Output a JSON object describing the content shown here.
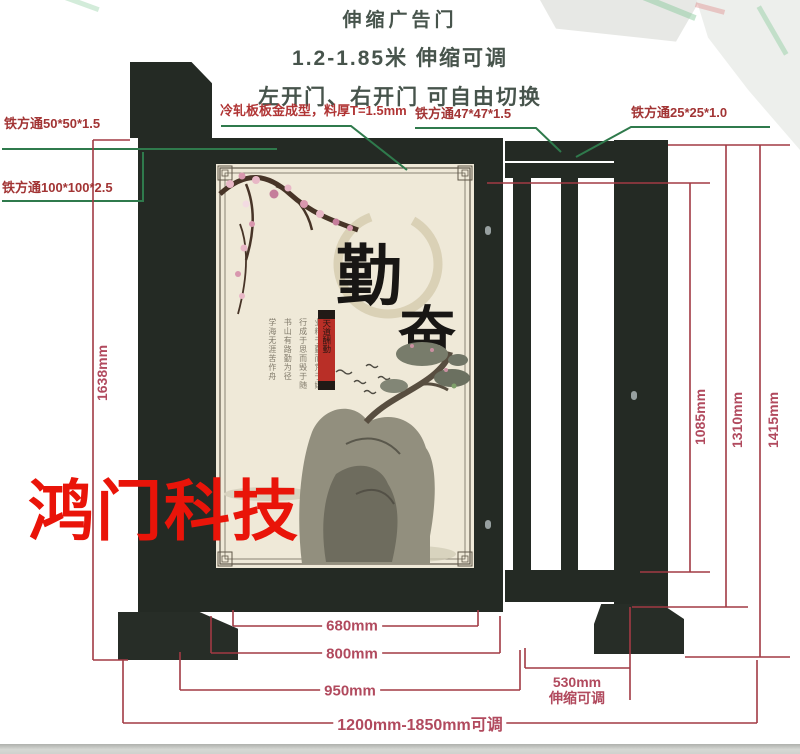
{
  "header": {
    "title": "伸缩广告门",
    "subtitle": "1.2-1.85米 伸缩可调",
    "note": "左开门、右开门 可自由切换"
  },
  "callouts": {
    "tube50": "铁方通50*50*1.5",
    "tube100": "铁方通100*100*2.5",
    "cold_plate": "冷轧板板金成型，料厚T=1.5mm",
    "tube47": "铁方通47*47*1.5",
    "tube25": "铁方通25*25*1.0"
  },
  "dimensions": {
    "height_left": "1638mm",
    "height_inner": "1085mm",
    "height_frame": "1310mm",
    "height_total": "1415mm",
    "width_panel": "680mm",
    "width_door": "800mm",
    "width_door_post": "950mm",
    "width_total": "1200mm-1850mm可调",
    "telescopic_value": "530mm",
    "telescopic_note": "伸缩可调"
  },
  "panel": {
    "calligraphy_1": "勤",
    "calligraphy_2": "奋",
    "seal_text": "天道酬勤",
    "columns": [
      "业精于勤而荒于嬉",
      "行成于思而毁于随",
      "书山有路勤为径",
      "学海无涯苦作舟"
    ]
  },
  "watermark": "鸿门科技",
  "colors": {
    "structure": "#242a24",
    "leader_line": "#2f7a4c",
    "dimension_line": "#a23a44",
    "dimension_text": "#b14a5e",
    "callout_text": "#a23434",
    "watermark": "#e91409",
    "panel_bg": "#efe9d8"
  }
}
